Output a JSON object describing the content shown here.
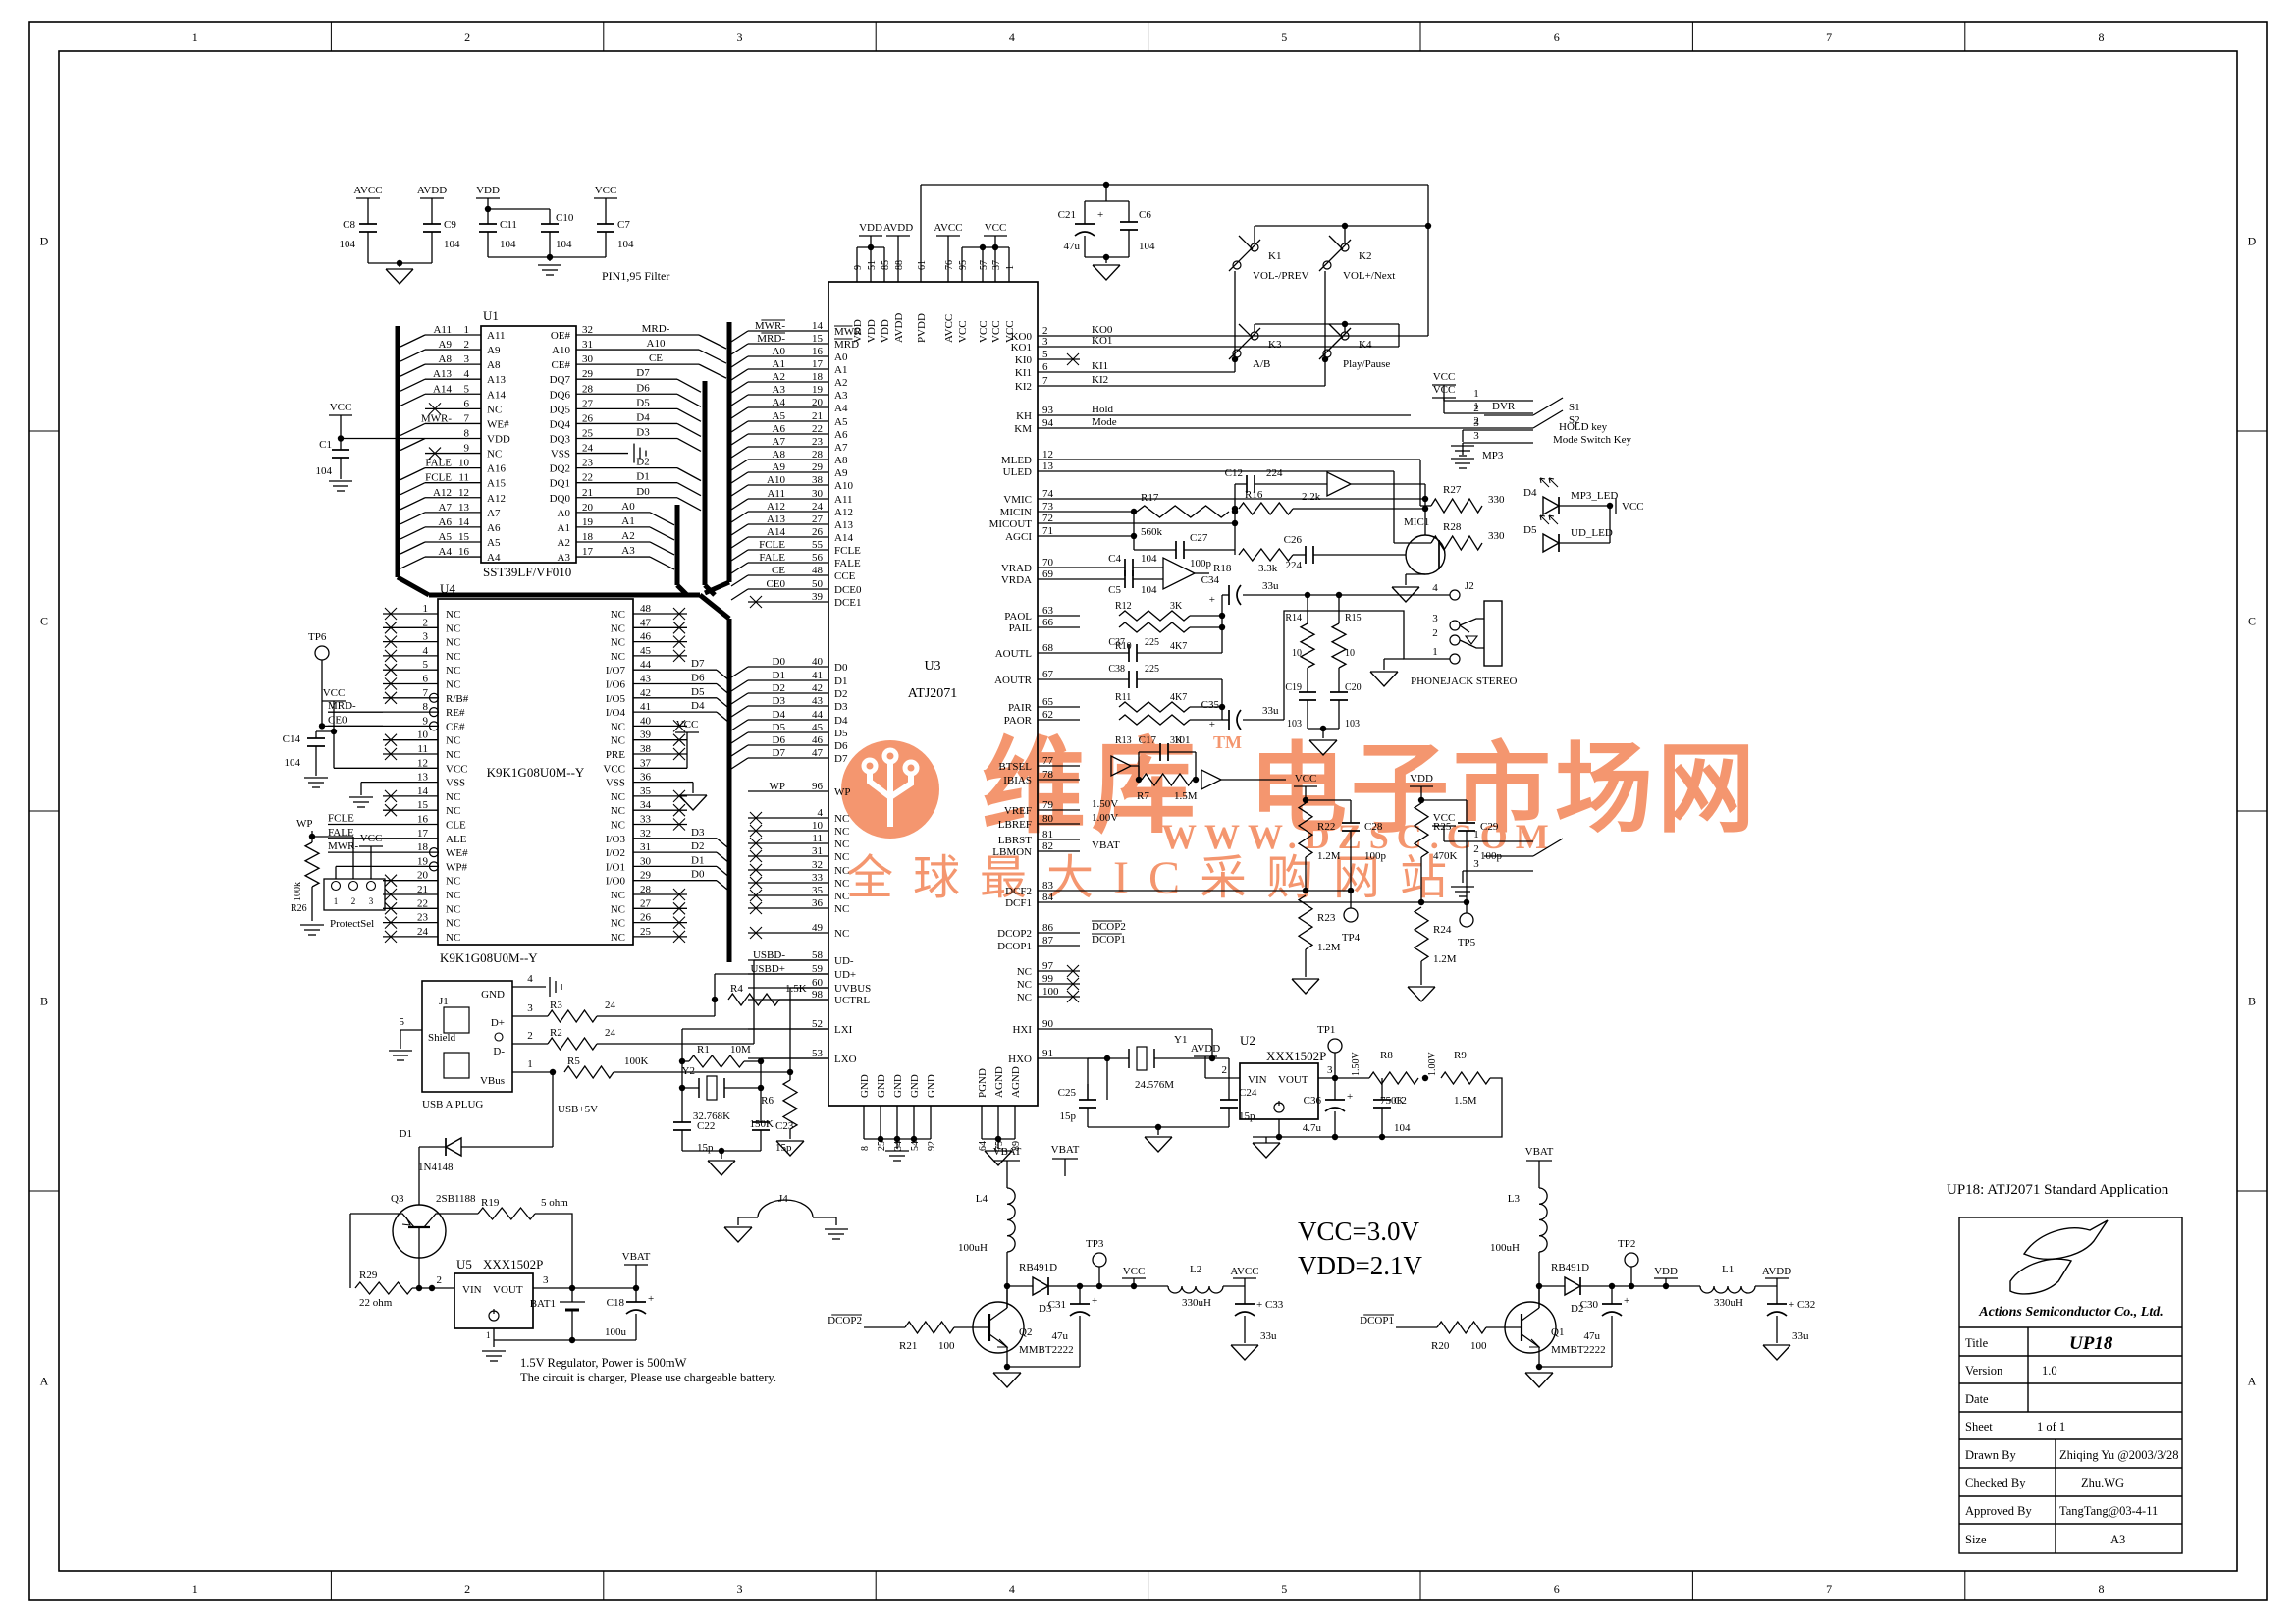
{
  "sheet": {
    "cols": [
      "1",
      "2",
      "3",
      "4",
      "5",
      "6",
      "7",
      "8"
    ],
    "rows": [
      "D",
      "C",
      "B",
      "A"
    ],
    "app_note": "UP18: ATJ2071 Standard Application"
  },
  "notes": {
    "filter": "PIN1,95 Filter",
    "reg1": "1.5V Regulator, Power is 500mW",
    "reg2": "The circuit is charger, Please use chargeable battery.",
    "vcc": "VCC=3.0V",
    "vdd": "VDD=2.1V"
  },
  "watermark": {
    "brand": "维库",
    "tm": "TM",
    "brand2": "电子市场网",
    "url": "WWW.DZSC.COM",
    "slogan": "全球最大IC采购网站",
    "color": "#f28050"
  },
  "title_block": {
    "company": "Actions Semiconductor Co., Ltd.",
    "fields": [
      {
        "label": "Title",
        "value": "UP18"
      },
      {
        "label": "Version",
        "value": "1.0"
      },
      {
        "label": "Date",
        "value": ""
      },
      {
        "label": "Sheet",
        "value": "1          of          1"
      },
      {
        "label": "Drawn By",
        "value": "Zhiqing Yu @2003/3/28"
      },
      {
        "label": "Checked By",
        "value": "Zhu.WG"
      },
      {
        "label": "Approved By",
        "value": "TangTang@03-4-11"
      },
      {
        "label": "Size",
        "value": "A3"
      }
    ]
  },
  "u1": {
    "ref": "U1",
    "part": "SST39LF/VF010",
    "left": [
      [
        "A11",
        "1",
        "A11"
      ],
      [
        "A9",
        "2",
        "A9"
      ],
      [
        "A8",
        "3",
        "A8"
      ],
      [
        "A13",
        "4",
        "A13"
      ],
      [
        "A14",
        "5",
        "A14"
      ],
      [
        "",
        "6",
        "NC",
        "x"
      ],
      [
        "MWR-",
        "7",
        "WE#"
      ],
      [
        "",
        "8",
        "VDD",
        "vcc"
      ],
      [
        "",
        "9",
        "NC",
        "x"
      ],
      [
        "FALE",
        "10",
        "A16"
      ],
      [
        "FCLE",
        "11",
        "A15"
      ],
      [
        "A12",
        "12",
        "A12"
      ],
      [
        "A7",
        "13",
        "A7"
      ],
      [
        "A6",
        "14",
        "A6"
      ],
      [
        "A5",
        "15",
        "A5"
      ],
      [
        "A4",
        "16",
        "A4"
      ]
    ],
    "right": [
      [
        "32",
        "MRD-",
        "OE#"
      ],
      [
        "31",
        "A10",
        "A10"
      ],
      [
        "30",
        "CE",
        "CE#"
      ],
      [
        "29",
        "D7",
        "DQ7"
      ],
      [
        "28",
        "D6",
        "DQ6"
      ],
      [
        "27",
        "D5",
        "DQ5"
      ],
      [
        "26",
        "D4",
        "DQ4"
      ],
      [
        "25",
        "D3",
        "DQ3"
      ],
      [
        "24",
        "",
        "VSS",
        "gnd"
      ],
      [
        "23",
        "D2",
        "DQ2"
      ],
      [
        "22",
        "D1",
        "DQ1"
      ],
      [
        "21",
        "D0",
        "DQ0"
      ],
      [
        "20",
        "A0",
        "A0"
      ],
      [
        "19",
        "A1",
        "A1"
      ],
      [
        "18",
        "A2",
        "A2"
      ],
      [
        "17",
        "A3",
        "A3"
      ]
    ]
  },
  "u4": {
    "ref": "U4",
    "part": "K9K1G08U0M--Y",
    "center": "K9K1G08U0M--Y",
    "left": [
      [
        "1",
        "NC",
        "",
        "x"
      ],
      [
        "2",
        "NC",
        "",
        "x"
      ],
      [
        "3",
        "NC",
        "",
        "x"
      ],
      [
        "4",
        "NC",
        "",
        "x"
      ],
      [
        "5",
        "NC",
        "",
        "x"
      ],
      [
        "6",
        "NC",
        "",
        "x"
      ],
      [
        "7",
        "R/B#",
        "",
        "xb"
      ],
      [
        "8",
        "RE#",
        "MRD-",
        "b"
      ],
      [
        "9",
        "CE#",
        "CE0",
        "b"
      ],
      [
        "10",
        "NC",
        "",
        "x"
      ],
      [
        "11",
        "NC",
        "",
        "x"
      ],
      [
        "12",
        "VCC",
        "",
        "vcc"
      ],
      [
        "13",
        "VSS",
        "",
        "gnd"
      ],
      [
        "14",
        "NC",
        "",
        "x"
      ],
      [
        "15",
        "NC",
        "",
        "x"
      ],
      [
        "16",
        "CLE",
        "FCLE"
      ],
      [
        "17",
        "ALE",
        "FALE"
      ],
      [
        "18",
        "WE#",
        "MWR-",
        "b"
      ],
      [
        "19",
        "WP#",
        "",
        "b"
      ],
      [
        "20",
        "NC",
        "",
        "x"
      ],
      [
        "21",
        "NC",
        "",
        "x"
      ],
      [
        "22",
        "NC",
        "",
        "x"
      ],
      [
        "23",
        "NC",
        "",
        "x"
      ],
      [
        "24",
        "NC",
        "",
        "x"
      ]
    ],
    "right": [
      [
        "48",
        "NC",
        "",
        "x"
      ],
      [
        "47",
        "NC",
        "",
        "x"
      ],
      [
        "46",
        "NC",
        "",
        "x"
      ],
      [
        "45",
        "NC",
        "",
        "x"
      ],
      [
        "44",
        "I/O7",
        "D7"
      ],
      [
        "43",
        "I/O6",
        "D6"
      ],
      [
        "42",
        "I/O5",
        "D5"
      ],
      [
        "41",
        "I/O4",
        "D4"
      ],
      [
        "40",
        "NC",
        "",
        "x"
      ],
      [
        "39",
        "NC",
        "",
        "x"
      ],
      [
        "38",
        "PRE",
        "",
        "x"
      ],
      [
        "37",
        "VCC",
        "",
        "vcc"
      ],
      [
        "36",
        "VSS",
        "",
        "gnd"
      ],
      [
        "35",
        "NC",
        "",
        "x"
      ],
      [
        "34",
        "NC",
        "",
        "x"
      ],
      [
        "33",
        "NC",
        "",
        "x"
      ],
      [
        "32",
        "I/O3",
        "D3"
      ],
      [
        "31",
        "I/O2",
        "D2"
      ],
      [
        "30",
        "I/O1",
        "D1"
      ],
      [
        "29",
        "I/O0",
        "D0"
      ],
      [
        "28",
        "NC",
        "",
        "x"
      ],
      [
        "27",
        "NC",
        "",
        "x"
      ],
      [
        "26",
        "NC",
        "",
        "x"
      ],
      [
        "25",
        "NC",
        "",
        "x"
      ]
    ]
  },
  "u3": {
    "ref": "U3",
    "part": "ATJ2071",
    "left": [
      [
        "MWR-",
        "14",
        "MWR",
        "ov"
      ],
      [
        "MRD-",
        "15",
        "MRD",
        "ov"
      ],
      [
        "A0",
        "16",
        "A0"
      ],
      [
        "A1",
        "17",
        "A1"
      ],
      [
        "A2",
        "18",
        "A2"
      ],
      [
        "A3",
        "19",
        "A3"
      ],
      [
        "A4",
        "20",
        "A4"
      ],
      [
        "A5",
        "21",
        "A5"
      ],
      [
        "A6",
        "22",
        "A6"
      ],
      [
        "A7",
        "23",
        "A7"
      ],
      [
        "A8",
        "28",
        "A8"
      ],
      [
        "A9",
        "29",
        "A9"
      ],
      [
        "A10",
        "38",
        "A10"
      ],
      [
        "A11",
        "30",
        "A11"
      ],
      [
        "A12",
        "24",
        "A12"
      ],
      [
        "A13",
        "27",
        "A13"
      ],
      [
        "A14",
        "26",
        "A14"
      ],
      [
        "FCLE",
        "55",
        "FCLE"
      ],
      [
        "FALE",
        "56",
        "FALE"
      ],
      [
        "CE",
        "48",
        "CCE"
      ],
      [
        "CE0",
        "50",
        "DCE0"
      ],
      [
        "",
        "39",
        "DCE1",
        "x"
      ],
      [
        "D0",
        "40",
        "D0"
      ],
      [
        "D1",
        "41",
        "D1"
      ],
      [
        "D2",
        "42",
        "D2"
      ],
      [
        "D3",
        "43",
        "D3"
      ],
      [
        "D4",
        "44",
        "D4"
      ],
      [
        "D5",
        "45",
        "D5"
      ],
      [
        "D6",
        "46",
        "D6"
      ],
      [
        "D7",
        "47",
        "D7"
      ],
      [
        "WP",
        "96",
        "WP"
      ],
      [
        "",
        "4",
        "NC",
        "x"
      ],
      [
        "",
        "10",
        "NC",
        "x"
      ],
      [
        "",
        "11",
        "NC",
        "x"
      ],
      [
        "",
        "31",
        "NC",
        "x"
      ],
      [
        "",
        "32",
        "NC",
        "x"
      ],
      [
        "",
        "33",
        "NC",
        "x"
      ],
      [
        "",
        "35",
        "NC",
        "x"
      ],
      [
        "",
        "36",
        "NC",
        "x"
      ],
      [
        "",
        "49",
        "NC",
        "x"
      ],
      [
        "USBD-",
        "58",
        "UD-"
      ],
      [
        "USBD+",
        "59",
        "UD+"
      ],
      [
        "",
        "60",
        "UVBUS"
      ],
      [
        "",
        "98",
        "UCTRL"
      ],
      [
        "",
        "52",
        "LXI"
      ],
      [
        "",
        "53",
        "LXO"
      ]
    ],
    "right": [
      [
        "KO0",
        "2",
        "KO0"
      ],
      [
        "KO1",
        "3",
        "KO1"
      ],
      [
        "KI0",
        "5",
        "",
        "x"
      ],
      [
        "KI1",
        "6",
        "KI1"
      ],
      [
        "KI2",
        "7",
        "KI2"
      ],
      [
        "KH",
        "93",
        "Hold"
      ],
      [
        "KM",
        "94",
        "Mode"
      ],
      [
        "MLED",
        "12",
        ""
      ],
      [
        "ULED",
        "13",
        ""
      ],
      [
        "VMIC",
        "74",
        ""
      ],
      [
        "MICIN",
        "73",
        ""
      ],
      [
        "MICOUT",
        "72",
        ""
      ],
      [
        "AGCI",
        "71",
        ""
      ],
      [
        "VRAD",
        "70",
        ""
      ],
      [
        "VRDA",
        "69",
        ""
      ],
      [
        "PAOL",
        "63",
        ""
      ],
      [
        "PAIL",
        "66",
        ""
      ],
      [
        "AOUTL",
        "68",
        ""
      ],
      [
        "AOUTR",
        "67",
        ""
      ],
      [
        "PAIR",
        "65",
        ""
      ],
      [
        "PAOR",
        "62",
        ""
      ],
      [
        "BTSEL",
        "77",
        ""
      ],
      [
        "IBIAS",
        "78",
        ""
      ],
      [
        "VREF",
        "79",
        "1.50V"
      ],
      [
        "LBREF",
        "80",
        "1.00V"
      ],
      [
        "LBRST",
        "81",
        ""
      ],
      [
        "LBMON",
        "82",
        "VBAT"
      ],
      [
        "DCF2",
        "83",
        ""
      ],
      [
        "DCF1",
        "84",
        ""
      ],
      [
        "DCOP2",
        "86",
        "DCOP2",
        "ovnet"
      ],
      [
        "DCOP1",
        "87",
        "DCOP1",
        "ovnet"
      ],
      [
        "NC",
        "97",
        "",
        "x"
      ],
      [
        "NC",
        "99",
        "",
        "x"
      ],
      [
        "NC",
        "100",
        "",
        "x"
      ],
      [
        "HXI",
        "90",
        ""
      ],
      [
        "HXO",
        "91",
        ""
      ]
    ],
    "top": [
      [
        "VDD",
        "9"
      ],
      [
        "VDD",
        "51"
      ],
      [
        "VDD",
        "85"
      ],
      [
        "AVDD",
        "88"
      ],
      [
        "PVDD",
        "61"
      ],
      [
        "AVCC",
        "76"
      ],
      [
        "VCC",
        "95"
      ],
      [
        "VCC",
        "57"
      ],
      [
        "VCC",
        "37"
      ],
      [
        "VCC",
        "1"
      ]
    ],
    "bottom": [
      [
        "GND",
        "8"
      ],
      [
        "GND",
        "25"
      ],
      [
        "GND",
        "34"
      ],
      [
        "GND",
        "54"
      ],
      [
        "GND",
        "92"
      ],
      [
        "PGND",
        "64"
      ],
      [
        "AGND",
        "75"
      ],
      [
        "AGND",
        "89"
      ]
    ]
  },
  "parts": {
    "C1": "104",
    "C2": "104",
    "C4": "104",
    "C5": "104",
    "C6": "104",
    "C7": "104",
    "C8": "104",
    "C9": "104",
    "C10": "104",
    "C11": "104",
    "C12": "224",
    "C14": "104",
    "C17": "101",
    "C18": "100u",
    "C19": "103",
    "C20": "103",
    "C21": "47u",
    "C22": "15p",
    "C23": "15p",
    "C24": "15p",
    "C25": "15p",
    "C26": "224",
    "C27": "100p",
    "C28": "100p",
    "C29": "100p",
    "C30": "47u",
    "C31": "47u",
    "C32": "33u",
    "C33": "33u",
    "C34": "33u",
    "C35": "33u",
    "C36": "4.7u",
    "C37": "225",
    "C38": "225",
    "R1": "10M",
    "R2": "24",
    "R3": "24",
    "R4": "1.5K",
    "R5": "100K",
    "R6": "150K",
    "R7": "1.5M",
    "R8": "750K",
    "R9": "1.5M",
    "R10": "4K7",
    "R11": "4K7",
    "R12": "3K",
    "R13": "3K",
    "R14": "10",
    "R15": "10",
    "R16": "2.2k",
    "R17": "560k",
    "R18": "3.3k",
    "R19": "5 ohm",
    "R20": "100",
    "R21": "100",
    "R22": "1.2M",
    "R23": "1.2M",
    "R24": "1.2M",
    "R25": "470K",
    "R26": "100k",
    "R27": "330",
    "R28": "330",
    "R29": "22 ohm",
    "L1": "330uH",
    "L2": "330uH",
    "L3": "100uH",
    "L4": "100uH",
    "Y1": "24.576M",
    "Y2": "32.768K",
    "D1": "1N4148",
    "D2": "RB491D",
    "D3": "RB491D",
    "Q1": "MMBT2222",
    "Q2": "MMBT2222",
    "Q3": "2SB1188",
    "U2": "XXX1502P",
    "U5": "XXX1502P"
  },
  "nets": {
    "vcc": "VCC",
    "vdd": "VDD",
    "avcc": "AVCC",
    "avdd": "AVDD",
    "vbat": "VBAT",
    "usb5": "USB+5V"
  },
  "misc": {
    "mic": "MIC1",
    "bat": "BAT1",
    "j1": "J1",
    "usbplug": "USB A PLUG",
    "shield": "Shield",
    "gnd": "GND",
    "dp": "D+",
    "dm": "D-",
    "vbus": "VBus",
    "j2": "J2",
    "phonejack": "PHONEJACK STEREO",
    "j4": "J4",
    "s1": "S1",
    "s1name": "HOLD key",
    "s2": "S2",
    "s2name": "Mode Switch Key",
    "dvr": "DVR",
    "mp3": "MP3",
    "k1": "K1",
    "k1name": "VOL-/PREV",
    "k2": "K2",
    "k2name": "VOL+/Next",
    "k3": "K3",
    "k3name": "A/B",
    "k4": "K4",
    "k4name": "Play/Pause",
    "mp3led": "MP3_LED",
    "udled": "UD_LED",
    "d4": "D4",
    "d5": "D5",
    "tp1": "TP1",
    "tp2": "TP2",
    "tp3": "TP3",
    "tp4": "TP4",
    "tp5": "TP5",
    "tp6": "TP6",
    "vin": "VIN",
    "vout": "VOUT",
    "protect": "ProtectSel",
    "wp": "WP",
    "v150": "1.50V",
    "v100": "1.00V"
  }
}
